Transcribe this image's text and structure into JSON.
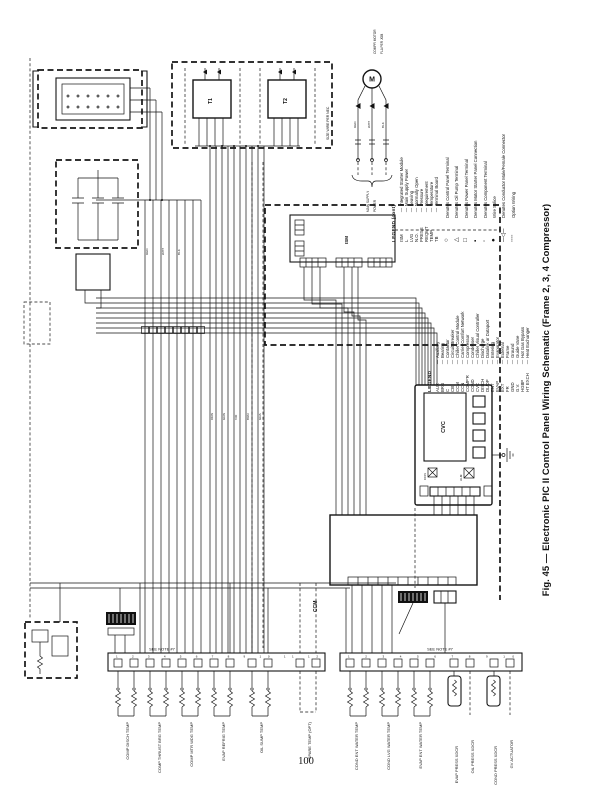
{
  "page": {
    "number": "100"
  },
  "figure": {
    "caption": "Fig. 45 — Electronic PIC II Control Panel Wiring Schematic (Frame 2, 3, 4 Compressor)"
  },
  "ui": {
    "dash": "—"
  },
  "legend_cont": {
    "title": "LEGEND (cont)",
    "items": [
      {
        "abbr": "ISM",
        "meaning": "Integrated Starter Module"
      },
      {
        "abbr": "L",
        "meaning": "Main Supply Power"
      },
      {
        "abbr": "LVG",
        "meaning": "Leaving"
      },
      {
        "abbr": "N.O.",
        "meaning": "Normally Open"
      },
      {
        "abbr": "PRESS",
        "meaning": "Pressure"
      },
      {
        "abbr": "REQMT",
        "meaning": "Requirement"
      },
      {
        "abbr": "TEMP",
        "meaning": "Temperature"
      },
      {
        "abbr": "TB",
        "meaning": "Terminal Board"
      }
    ],
    "symbols": [
      {
        "glyph": "○",
        "text": "Denotes Control Panel Terminal"
      },
      {
        "glyph": "△",
        "text": "Denotes Oil Pump Terminal"
      },
      {
        "glyph": "□",
        "text": "Denotes Power Panel Terminal"
      },
      {
        "glyph": "▪",
        "text": "Denotes Motor Starter Panel Connection"
      },
      {
        "glyph": "◦",
        "text": "Denotes Component Terminal"
      },
      {
        "glyph": "●",
        "text": "Wire Splice"
      },
      {
        "glyph": "─◁─",
        "text": "Denotes Conductor Male/Female Connector"
      },
      {
        "glyph": "╌╌",
        "text": "Option Wiring"
      }
    ]
  },
  "legend": {
    "title": "LEGEND",
    "items": [
      {
        "abbr": "AUX",
        "meaning": "Auxiliary"
      },
      {
        "abbr": "BRG",
        "meaning": "Bearing"
      },
      {
        "abbr": "C",
        "meaning": "Contactor"
      },
      {
        "abbr": "CB",
        "meaning": "Circuit Breaker"
      },
      {
        "abbr": "CCM",
        "meaning": "Chiller Control Module"
      },
      {
        "abbr": "CCN",
        "meaning": "Carrier Comfort Network"
      },
      {
        "abbr": "COMP'R",
        "meaning": "Compressor"
      },
      {
        "abbr": "COND",
        "meaning": "Condenser"
      },
      {
        "abbr": "CVC",
        "meaning": "Chiller Visual Controller"
      },
      {
        "abbr": "DISCH",
        "meaning": "Discharge"
      },
      {
        "abbr": "DL/DP",
        "meaning": "Datalink or Dataport"
      },
      {
        "abbr": "ENT",
        "meaning": "Entering"
      },
      {
        "abbr": "EVAP",
        "meaning": "Evaporator"
      },
      {
        "abbr": "EXT",
        "meaning": "External"
      },
      {
        "abbr": "FR",
        "meaning": "Frame"
      },
      {
        "abbr": "GND",
        "meaning": "Ground"
      },
      {
        "abbr": "G.V.",
        "meaning": "Guide Vane"
      },
      {
        "abbr": "HGBP",
        "meaning": "Hot Gas Bypass"
      },
      {
        "abbr": "HT EXCH",
        "meaning": "Heat Exchanger"
      }
    ]
  },
  "modules": {
    "motor": "M",
    "cvc": "CVC",
    "ccm": "CCM",
    "ism": "ISM",
    "t1": "T1",
    "t2": "T2",
    "cvc_led_left": "CCN",
    "cvc_led_right": "ALM"
  },
  "notes": {
    "motor_1": "COMPR MOTOR",
    "motor_2": "FLA PER JOB",
    "supply_1": "MAIN SUPPLY",
    "supply_2": "POWER",
    "nec": "SIZE WIRE PER NEC"
  },
  "strips": {
    "strip1": {
      "header": "SEE NOTE #7",
      "numbers": "1 2 3 4 5 6 7 8 9 10 11 12"
    },
    "strip2": {
      "header": "SEE NOTE #7",
      "numbers": "1 2 3 4 5 6 7 8 9 10"
    }
  },
  "sensors": {
    "strip1": [
      "COMP DISCH TEMP",
      "COMP THRUST BRG TEMP",
      "COMP MTR WDG TEMP",
      "EVAP REFRIG TEMP",
      "OIL SUMP TEMP",
      "SPARE TEMP (OPT)"
    ],
    "strip2": [
      "COND ENT WATER TEMP",
      "COND LVG WATER TEMP",
      "EVAP ENT WATER TEMP",
      "EVAP PRESS XDCR",
      "COND PRESS XDCR",
      "OIL PRESS XDCR",
      "GV ACTUATOR"
    ]
  },
  "wire_labels": [
    "RED",
    "WHT",
    "BLK",
    "ORN",
    "GRN",
    "VIO",
    "BRN",
    "GRA"
  ]
}
